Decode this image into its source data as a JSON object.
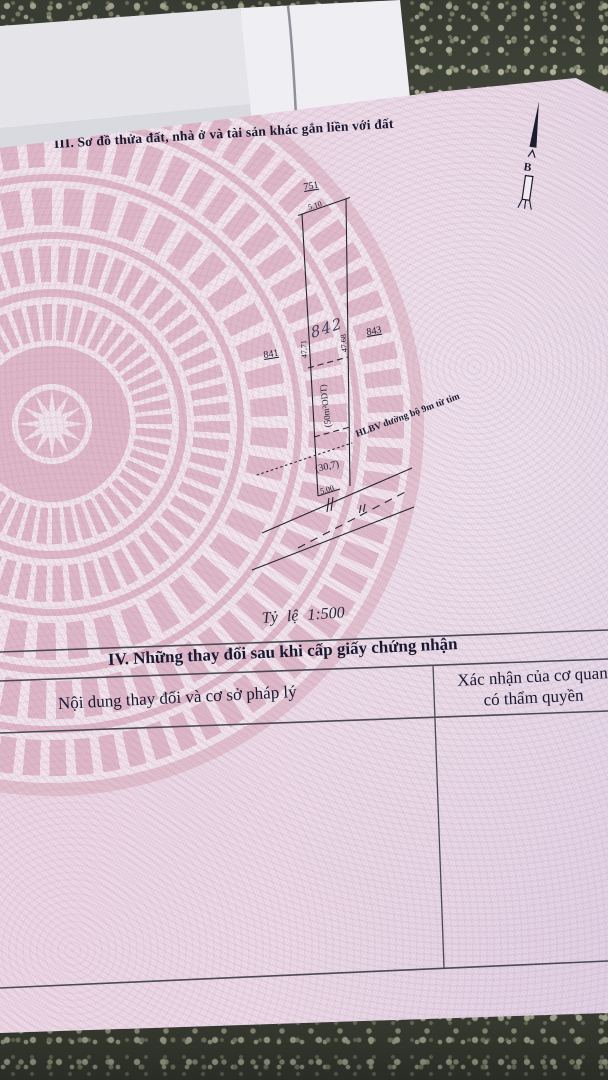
{
  "doc": {
    "section3_title": "III. Sơ đồ thửa đất, nhà ở và tài sản khác gắn liền với đất",
    "north_label": "B",
    "scale_label": "Tỷ lệ 1:500",
    "section4_title": "IV. Những thay đổi sau khi cấp giấy chứng nhận",
    "table": {
      "col_left_header": "Nội dung thay đổi và cơ sở pháp lý",
      "col_right_line1": "Xác nhận của cơ quan",
      "col_right_line2": "có thẩm quyền"
    }
  },
  "diagram": {
    "parcel_top": "751",
    "parcel_left": "841",
    "parcel_right": "843",
    "parcel_handwritten": "842",
    "dim_top": "5.10",
    "dim_left": "47.71",
    "dim_right": "47.68",
    "dim_bottom": "5.00",
    "area_note": "(50m²ODT)",
    "corridor_note": "HLBV đường bộ 9m từ tim",
    "road_note": "(30,7)"
  },
  "colors": {
    "paper_pink": "#ecdde9",
    "drum_rose": "#d6a5b6",
    "ink": "#1c1c30",
    "table_line": "#4a4a55",
    "floor": "#43483c",
    "envelope_white": "#eeeef3"
  }
}
